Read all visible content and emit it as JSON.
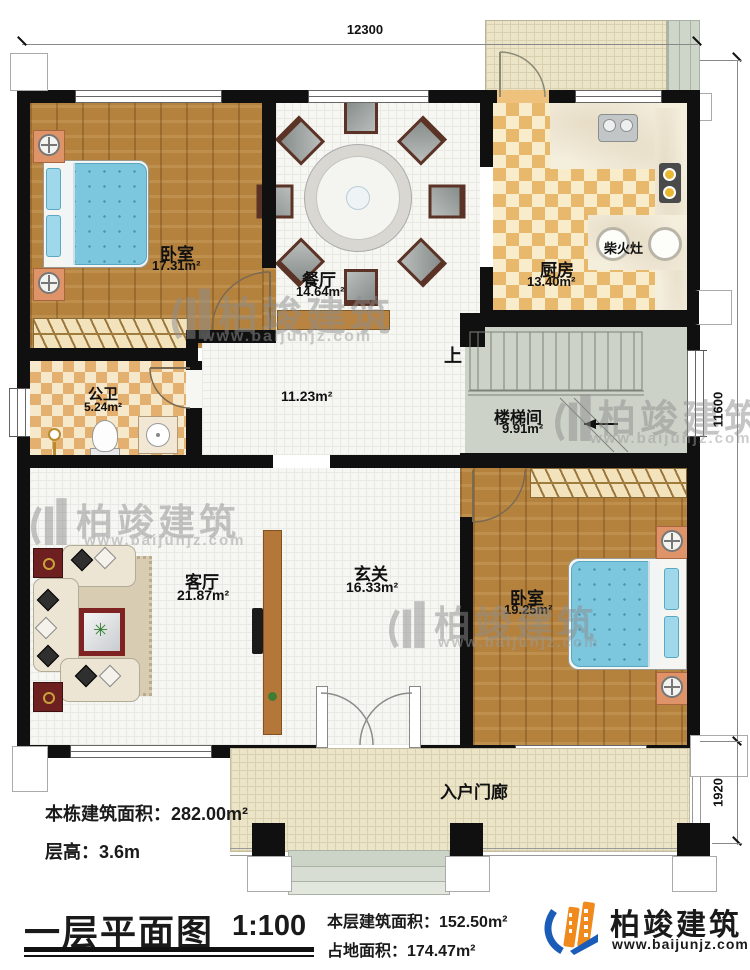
{
  "dimensions": {
    "top": "12300",
    "right_main": "11600",
    "right_porch": "1920"
  },
  "rooms": {
    "bedroom1": {
      "name": "卧室",
      "area": "17.31m²"
    },
    "dining": {
      "name": "餐厅",
      "area": "14.64m²"
    },
    "kitchen": {
      "name": "厨房",
      "area": "13.40m²"
    },
    "wood_stove": {
      "name": "柴火灶"
    },
    "bathroom": {
      "name": "公卫",
      "area": "5.24m²"
    },
    "hall": {
      "area": "11.23m²"
    },
    "stairwell": {
      "name": "楼梯间",
      "area": "9.91m²",
      "up": "上"
    },
    "living": {
      "name": "客厅",
      "area": "21.87m²"
    },
    "foyer": {
      "name": "玄关",
      "area": "16.33m²"
    },
    "bedroom2": {
      "name": "卧室",
      "area": "19.25m²"
    },
    "porch": {
      "name": "入户门廊"
    }
  },
  "annotations": {
    "building_area": "本栋建筑面积：282.00m²",
    "floor_height": "层高：3.6m"
  },
  "titleblock": {
    "plan_title": "一层平面图",
    "scale": "1:100",
    "floor_area": "本层建筑面积：152.50m²",
    "land_area": "占地面积：174.47m²"
  },
  "brand": {
    "name": "柏竣建筑",
    "url": "www.baijunjz.com"
  },
  "watermark": {
    "name": "柏竣建筑",
    "url": "www.baijunjz.com"
  },
  "colors": {
    "wall": "#101010",
    "wood_floor": "#b5823e",
    "warm_tile": "#e8b86d",
    "brand_blue": "#1b5cb8",
    "brand_orange": "#f08a1d"
  }
}
